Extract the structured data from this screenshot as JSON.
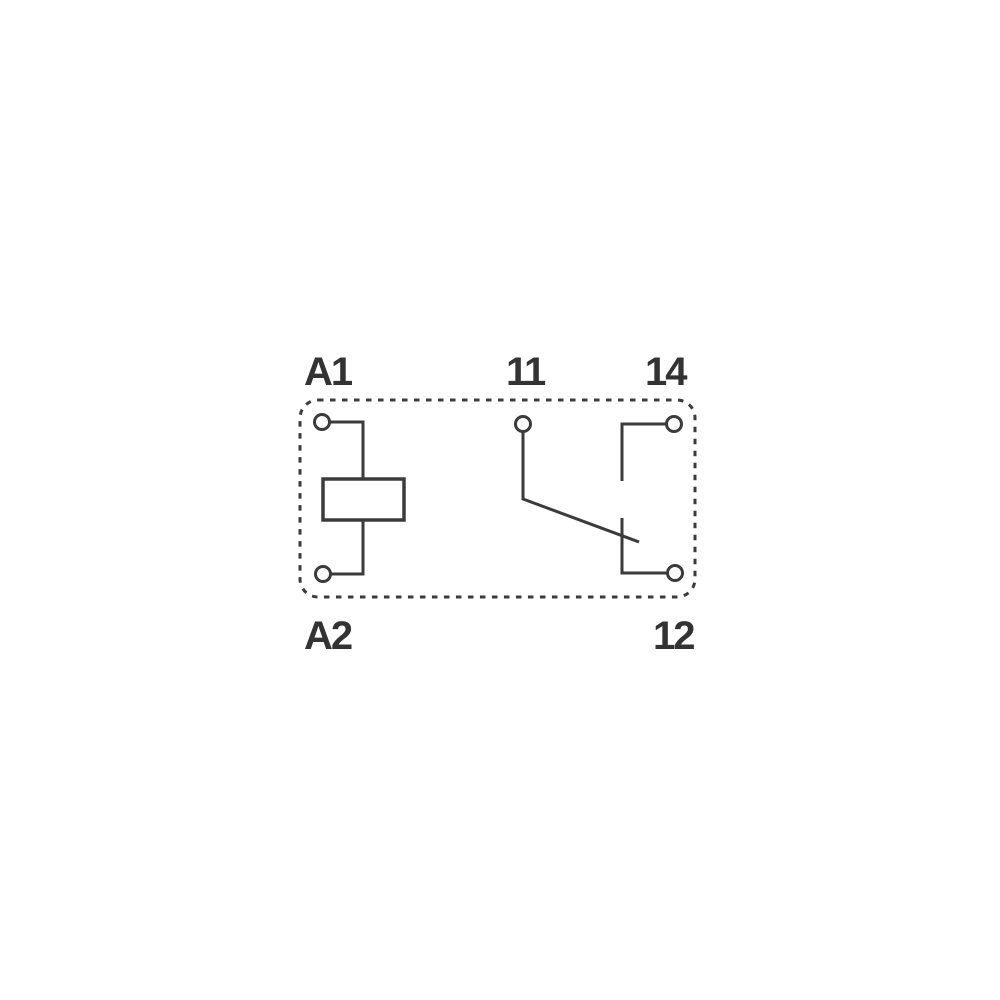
{
  "diagram": {
    "type": "relay-contact-schematic",
    "colors": {
      "line-color": "#3b3b3b",
      "label-color": "#333333",
      "background": "#ffffff"
    },
    "terminals": {
      "a1": {
        "label": "A1"
      },
      "a2": {
        "label": "A2"
      },
      "t11": {
        "label": "11"
      },
      "t12": {
        "label": "12"
      },
      "t14": {
        "label": "14"
      }
    }
  }
}
